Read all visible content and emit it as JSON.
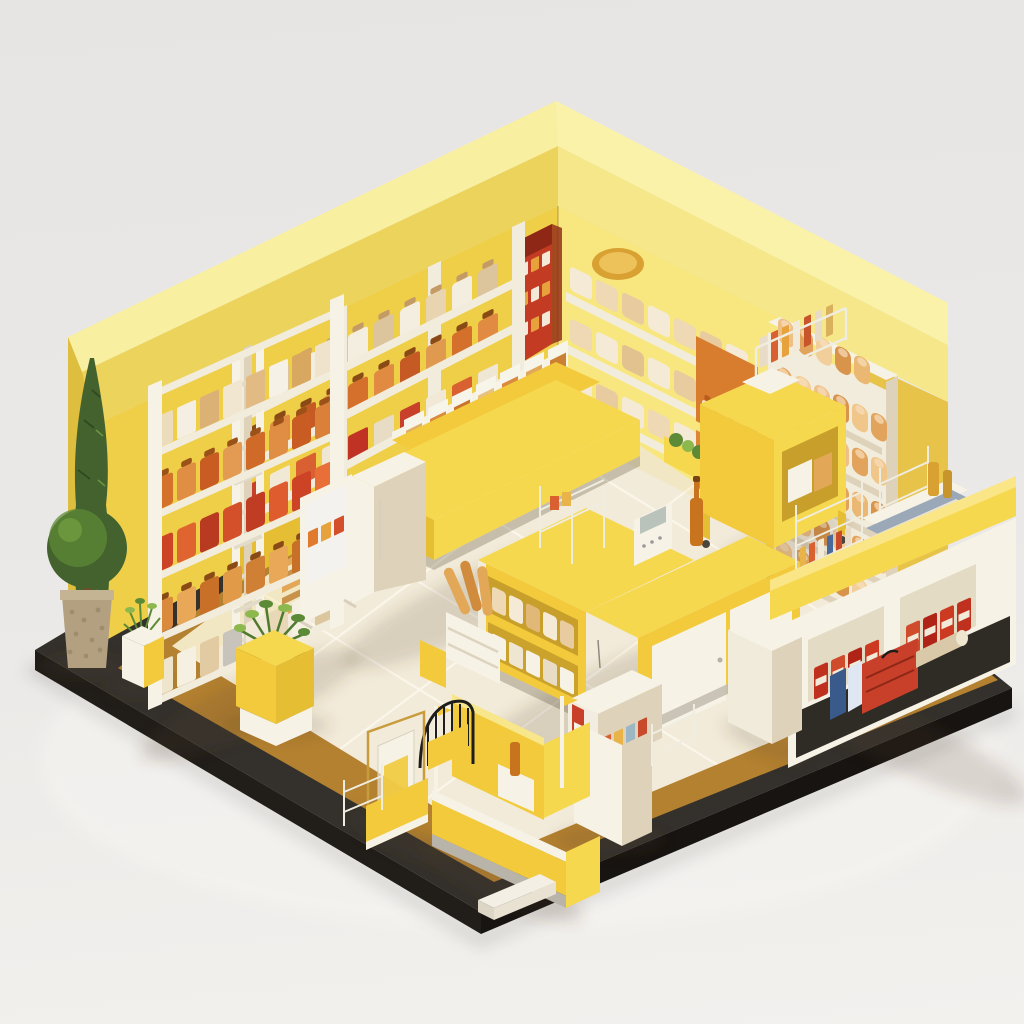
{
  "meta": {
    "title": "Isometric miniature store diorama",
    "description": "3D isometric cutaway render of a yellow-themed miniature grocery/bakery shop: two yellow walls with pale roof band, cream tiled floor on a black platform with bronze trim, shelves of packaged goods, bread display, checkout counters, kiosks, entry gate and plants. No text is visible in the image.",
    "canvas": {
      "width": 1024,
      "height": 1024
    }
  },
  "palette": {
    "bg_top": "#e7e5e4",
    "bg_mid": "#ebe9e7",
    "bg_bottom": "#f3f1ee",
    "base_top": "#34312c",
    "base_side_left": "#211e1a",
    "base_side_right": "#171411",
    "bronze": "#b38130",
    "floor": "#f2ebd9",
    "tile_line": "#fbf7eb",
    "roof_top_left": "#f8efa0",
    "roof_top_right": "#faf2a8",
    "fascia_left": "#ecd35c",
    "fascia_right": "#f5e78a",
    "wall_left": "#efcf48",
    "wall_right": "#f8e77e",
    "wall_end": "#ddbe3e",
    "wall_wing": "#e7c34a",
    "cream": "#f2ecdc",
    "cream_dark": "#ded2ba",
    "white_warm": "#f6f2e6",
    "yellow_bright": "#f6d84e",
    "yellow_mid": "#f2ca3c",
    "yellow_deep": "#e6be34",
    "yellow_shade": "#c79f2a",
    "red": "#c8402a",
    "red_deep": "#a8281a",
    "orange": "#d87c2e",
    "orange_deep": "#b85c20",
    "tan": "#e2a858",
    "gold": "#d9a032",
    "gold_light": "#edc25a",
    "amber": "#c8741e",
    "green_dark": "#44622e",
    "green_mid": "#5d8a36",
    "green_light": "#8db84e",
    "pot": "#b2a081",
    "metal": "#b9b4aa",
    "card_blue": "#4a6a9c",
    "pale_blue": "#dfe8f2",
    "wire_black": "#1d1d1d",
    "wire_white": "#efece0",
    "brass": "#c89c3c",
    "banner_red": "#c23b22",
    "banner_dark": "#8e2715"
  },
  "scene": {
    "objects": [
      {
        "name": "base-platform",
        "label": "black display platform with bronze trim band"
      },
      {
        "name": "floor",
        "label": "cream isometric tiled floor"
      },
      {
        "name": "left-wall",
        "label": "bright yellow left wall with pale roof band"
      },
      {
        "name": "right-wall",
        "label": "pale yellow right wall with roof band"
      },
      {
        "name": "corner-banner",
        "label": "red promotional banner at wall corner"
      },
      {
        "name": "wall-shelves-left",
        "label": "built-in wall bays with canisters and jars"
      },
      {
        "name": "wall-shelves-right",
        "label": "wall shelves with wrapped pastries, gold plate, orange niches"
      },
      {
        "name": "bread-display",
        "label": "tall bread case with five rows of loaves"
      },
      {
        "name": "ladder-shelf",
        "label": "white five-tier shelf of orange and red packaged goods"
      },
      {
        "name": "gondola",
        "label": "two-tier centre gondola with bins and boxes"
      },
      {
        "name": "fridge-cabinet",
        "label": "white cabinet at gondola end"
      },
      {
        "name": "poster-stand",
        "label": "poster display stand"
      },
      {
        "name": "pallet",
        "label": "slatted wooden pallet"
      },
      {
        "name": "service-cart",
        "label": "yellow service cart with magazine rack"
      },
      {
        "name": "checkout-island",
        "label": "yellow checkout island with white doors, register and bottle"
      },
      {
        "name": "baguette-crate",
        "label": "crate of baguettes at island end"
      },
      {
        "name": "right-counter",
        "label": "white counter with red cartons in cubbies and yellow top"
      },
      {
        "name": "under-counter-items",
        "label": "red toolbox, blue cartons, paper roll"
      },
      {
        "name": "pillar",
        "label": "cream structural pillar"
      },
      {
        "name": "card-kiosk",
        "label": "card dispenser machine on pedestal"
      },
      {
        "name": "front-kiosk",
        "label": "yellow checkout kiosk with silver trim"
      },
      {
        "name": "entry-gate",
        "label": "black wire entry arch"
      },
      {
        "name": "basket-stand",
        "label": "brass stand with bag and wire basket"
      },
      {
        "name": "planter-center",
        "label": "yellow cube planter with green plant"
      },
      {
        "name": "planter-small",
        "label": "small white and yellow pot plant"
      },
      {
        "name": "topiary",
        "label": "round topiary in speckled pot"
      },
      {
        "name": "cypress-tree",
        "label": "tall slim cypress tree"
      },
      {
        "name": "corner-tray",
        "label": "small white tray at platform corner"
      }
    ],
    "product_rows": [
      {
        "id": "ladder-1",
        "type": "box",
        "x": 154,
        "y": 450,
        "skew": -24,
        "step": 23,
        "count": 8,
        "w": 19,
        "h": 32,
        "rx": 2,
        "colors": [
          "#ecdcbc",
          "#f4efe2",
          "#dcb176",
          "#f1e6d0",
          "#e2bb84",
          "#f6f1e6",
          "#d9a860",
          "#efe3cc"
        ]
      },
      {
        "id": "ladder-2",
        "type": "jar",
        "x": 154,
        "y": 512,
        "skew": -24,
        "step": 23,
        "count": 8,
        "w": 19,
        "h": 32,
        "rx": 3,
        "cap": "#9a5218",
        "colors": [
          "#d4722c",
          "#e08e44",
          "#c85c22",
          "#e39a52",
          "#cf6a28",
          "#e08e44",
          "#c85c22",
          "#db8038"
        ]
      },
      {
        "id": "ladder-3",
        "type": "box",
        "x": 154,
        "y": 574,
        "skew": -24,
        "step": 23,
        "count": 8,
        "w": 19,
        "h": 34,
        "rx": 3,
        "colors": [
          "#cc4326",
          "#e06430",
          "#b83a20",
          "#d4502a",
          "#c03c22",
          "#df5c2e",
          "#cc4326",
          "#e87038"
        ]
      },
      {
        "id": "ladder-4",
        "type": "jar",
        "x": 154,
        "y": 636,
        "skew": -24,
        "step": 23,
        "count": 8,
        "w": 19,
        "h": 32,
        "rx": 3,
        "cap": "#8a4a16",
        "colors": [
          "#d98a3c",
          "#e8a858",
          "#c87028",
          "#e09a48",
          "#d08034",
          "#e8a858",
          "#c87028",
          "#dd9240"
        ]
      },
      {
        "id": "ladder-5",
        "type": "box",
        "x": 154,
        "y": 698,
        "skew": -24,
        "step": 23,
        "count": 8,
        "w": 19,
        "h": 34,
        "rx": 2,
        "colors": [
          "#efe4cc",
          "#f6f0e2",
          "#e2cba2",
          "#c8c4bc",
          "#f2e9d6",
          "#e8d8b8",
          "#f6f0e2",
          "#dcc69e"
        ]
      },
      {
        "id": "wallbay-1",
        "type": "jar",
        "x": 244,
        "y": 414,
        "skew": -26,
        "step": 26,
        "count": 10,
        "w": 20,
        "h": 28,
        "rx": 3,
        "cap": "#c49a66",
        "colors": [
          "#f4eee0",
          "#dcc49c",
          "#f4eee0",
          "#e8d4ae",
          "#f4eee0",
          "#dcc49c",
          "#f4eee0",
          "#e8d4ae",
          "#f4eee0",
          "#dcc49c"
        ]
      },
      {
        "id": "wallbay-2",
        "type": "jar",
        "x": 244,
        "y": 464,
        "skew": -26,
        "step": 26,
        "count": 10,
        "w": 20,
        "h": 28,
        "rx": 3,
        "cap": "#8a4a16",
        "colors": [
          "#d4702c",
          "#e08a42",
          "#c65a24",
          "#e09a50",
          "#d4702c",
          "#e08a42",
          "#c65a24",
          "#e09a50",
          "#d4702c",
          "#e08a42"
        ]
      },
      {
        "id": "wallbay-3",
        "type": "box",
        "x": 244,
        "y": 517,
        "skew": -26,
        "step": 26,
        "count": 10,
        "w": 20,
        "h": 30,
        "rx": 2,
        "colors": [
          "#c8402a",
          "#f2e8d6",
          "#d96030",
          "#efe6d4",
          "#c03224",
          "#e8dcc4",
          "#c8402a",
          "#f2e8d6",
          "#d96030",
          "#efe6d4"
        ]
      },
      {
        "id": "pastry-1",
        "type": "box",
        "x": 570,
        "y": 290,
        "skew": 26,
        "step": 26,
        "count": 7,
        "w": 22,
        "h": 24,
        "rx": 4,
        "colors": [
          "#f4ead6",
          "#eed9b4",
          "#e8cca0",
          "#f4ead6",
          "#eed9b4",
          "#e8cca0",
          "#f4ead6"
        ]
      },
      {
        "id": "pastry-2",
        "type": "box",
        "x": 570,
        "y": 342,
        "skew": 26,
        "step": 26,
        "count": 7,
        "w": 22,
        "h": 24,
        "rx": 4,
        "colors": [
          "#eed9b4",
          "#f4ead6",
          "#e2c28e",
          "#f4ead6",
          "#e8cca0",
          "#f4ead6",
          "#eed9b4"
        ]
      },
      {
        "id": "pastry-3",
        "type": "box",
        "x": 570,
        "y": 394,
        "skew": 26,
        "step": 26,
        "count": 7,
        "w": 22,
        "h": 24,
        "rx": 4,
        "colors": [
          "#f4ead6",
          "#e8cca0",
          "#f4ead6",
          "#eed9b4",
          "#f4ead6",
          "#e2c28e",
          "#f4ead6"
        ]
      },
      {
        "id": "niche-bottles",
        "type": "jar",
        "x": 702,
        "y": 423,
        "skew": 26,
        "step": 16,
        "count": 3,
        "w": 11,
        "h": 24,
        "rx": 3,
        "cap": "#b85c20",
        "colors": [
          "#f2e3c4",
          "#e8d4ae",
          "#f2e3c4"
        ]
      },
      {
        "id": "niche-red",
        "type": "box",
        "x": 702,
        "y": 490,
        "skew": 26,
        "step": 15,
        "count": 3,
        "w": 12,
        "h": 20,
        "rx": 2,
        "colors": [
          "#c8402a",
          "#d95a30",
          "#b83220"
        ]
      },
      {
        "id": "bread-0",
        "type": "bread",
        "x": 778,
        "y": 342,
        "skew": 26,
        "step": 19,
        "count": 5,
        "w": 16,
        "h": 26,
        "rx": 7,
        "colors": [
          "#eec088",
          "#e2a35c",
          "#f2cf9a",
          "#d8944a",
          "#eab873"
        ]
      },
      {
        "id": "bread-1",
        "type": "bread",
        "x": 776,
        "y": 390,
        "skew": 26,
        "step": 19,
        "count": 6,
        "w": 16,
        "h": 26,
        "rx": 7,
        "colors": [
          "#e2a35c",
          "#f2cf9a",
          "#eec088",
          "#d8944a",
          "#f0c68a",
          "#e2a35c"
        ]
      },
      {
        "id": "bread-2",
        "type": "bread",
        "x": 776,
        "y": 434,
        "skew": 26,
        "step": 19,
        "count": 6,
        "w": 16,
        "h": 26,
        "rx": 7,
        "colors": [
          "#f2cf9a",
          "#e2a35c",
          "#d8944a",
          "#eec088",
          "#e2a35c",
          "#f0c68a"
        ]
      },
      {
        "id": "bread-3",
        "type": "bread",
        "x": 776,
        "y": 478,
        "skew": 26,
        "step": 19,
        "count": 6,
        "w": 16,
        "h": 26,
        "rx": 7,
        "colors": [
          "#eec088",
          "#d8944a",
          "#f2cf9a",
          "#e2a35c",
          "#eab873",
          "#d8944a"
        ]
      },
      {
        "id": "bread-4",
        "type": "bread",
        "x": 776,
        "y": 522,
        "skew": 26,
        "step": 19,
        "count": 6,
        "w": 16,
        "h": 26,
        "rx": 7,
        "colors": [
          "#e2a35c",
          "#eec088",
          "#d8944a",
          "#f2cf9a",
          "#e2a35c",
          "#eec088"
        ]
      },
      {
        "id": "bread-5",
        "type": "bread",
        "x": 776,
        "y": 564,
        "skew": 26,
        "step": 19,
        "count": 6,
        "w": 16,
        "h": 26,
        "rx": 7,
        "colors": [
          "#f0c68a",
          "#e2a35c",
          "#eec088",
          "#d8944a",
          "#f2cf9a",
          "#e2a35c"
        ]
      },
      {
        "id": "gondola-bins",
        "type": "bin",
        "x": 404,
        "y": 446,
        "skew": -26,
        "step": 24,
        "count": 7,
        "w": 20,
        "h": 26,
        "rx": 1,
        "colors": [
          "#e0b064",
          "#d98a3c",
          "#c8742c",
          "#e8c080",
          "#d98a3c",
          "#e0a858",
          "#cc8034"
        ]
      },
      {
        "id": "gondola-lower",
        "type": "box",
        "x": 436,
        "y": 512,
        "skew": -26,
        "step": 30,
        "count": 4,
        "w": 26,
        "h": 32,
        "rx": 2,
        "colors": [
          "#f4efe2",
          "#efe4cc",
          "#f7d848",
          "#f2ead8"
        ]
      },
      {
        "id": "cart-cards",
        "type": "card",
        "x": 760,
        "y": 368,
        "skew": -25,
        "step": 11,
        "count": 7,
        "w": 7,
        "h": 30,
        "rx": 1,
        "colors": [
          "#e8dcc8",
          "#d96030",
          "#e8a23c",
          "#f2ead8",
          "#c8542a",
          "#e8dcc8",
          "#d9b05c"
        ]
      },
      {
        "id": "island-upper",
        "type": "box",
        "x": 492,
        "y": 610,
        "skew": 26,
        "step": 17,
        "count": 5,
        "w": 14,
        "h": 24,
        "rx": 3,
        "colors": [
          "#eed9b4",
          "#f4ead6",
          "#e2b878",
          "#f4ead6",
          "#e8cca0"
        ]
      },
      {
        "id": "island-lower",
        "type": "box",
        "x": 492,
        "y": 655,
        "skew": 26,
        "step": 17,
        "count": 5,
        "w": 14,
        "h": 22,
        "rx": 2,
        "colors": [
          "#f6f2e6",
          "#efe6d2",
          "#f6f2e6",
          "#e8dcc4",
          "#f6f2e6"
        ]
      },
      {
        "id": "cubby1-cartons",
        "type": "carton",
        "x": 814,
        "y": 700,
        "skew": -24,
        "step": 17,
        "count": 4,
        "w": 14,
        "h": 32,
        "rx": 2,
        "colors": [
          "#c0301f",
          "#d04a2c",
          "#b02418",
          "#cc3a22"
        ]
      },
      {
        "id": "cubby2-cartons",
        "type": "carton",
        "x": 906,
        "y": 658,
        "skew": -24,
        "step": 17,
        "count": 4,
        "w": 14,
        "h": 32,
        "rx": 2,
        "colors": [
          "#d04a2c",
          "#b02418",
          "#cc3a22",
          "#c0301f"
        ]
      },
      {
        "id": "counter-cards",
        "type": "card",
        "x": 884,
        "y": 536,
        "skew": -23,
        "step": 9,
        "count": 5,
        "w": 6,
        "h": 26,
        "rx": 1,
        "colors": [
          "#d96030",
          "#4a6a9c",
          "#e8b44a",
          "#c84a2c",
          "#8aa870"
        ]
      },
      {
        "id": "counter-cards2",
        "type": "card",
        "x": 800,
        "y": 572,
        "skew": -23,
        "step": 9,
        "count": 6,
        "w": 6,
        "h": 24,
        "rx": 1,
        "colors": [
          "#e8b44a",
          "#d96030",
          "#f2ead8",
          "#4a6a9c",
          "#c84a2c",
          "#e8dcc8"
        ]
      },
      {
        "id": "kiosk-cards",
        "type": "card",
        "x": 602,
        "y": 760,
        "skew": -25,
        "step": 12,
        "count": 4,
        "w": 9,
        "h": 22,
        "rx": 1,
        "colors": [
          "#d96030",
          "#e8b44a",
          "#9db6c4",
          "#c84a2c"
        ]
      },
      {
        "id": "banner-cards1",
        "type": "card",
        "x": 520,
        "y": 278,
        "skew": -26,
        "step": 11,
        "count": 3,
        "w": 8,
        "h": 13,
        "rx": 1,
        "colors": [
          "#f4e8d8",
          "#e8a23c",
          "#f4e8d8"
        ]
      },
      {
        "id": "banner-cards2",
        "type": "card",
        "x": 520,
        "y": 308,
        "skew": -26,
        "step": 11,
        "count": 3,
        "w": 8,
        "h": 13,
        "rx": 1,
        "colors": [
          "#e8a23c",
          "#f4e8d8",
          "#e8a23c"
        ]
      },
      {
        "id": "banner-cards3",
        "type": "card",
        "x": 520,
        "y": 338,
        "skew": -26,
        "step": 11,
        "count": 3,
        "w": 8,
        "h": 13,
        "rx": 1,
        "colors": [
          "#f4e8d8",
          "#e8a23c",
          "#f4e8d8"
        ]
      },
      {
        "id": "poster-thumbs",
        "type": "card",
        "x": 308,
        "y": 548,
        "skew": -25,
        "step": 13,
        "count": 3,
        "w": 10,
        "h": 16,
        "rx": 1,
        "colors": [
          "#e07a2c",
          "#e8a23c",
          "#d4502a"
        ]
      }
    ]
  }
}
